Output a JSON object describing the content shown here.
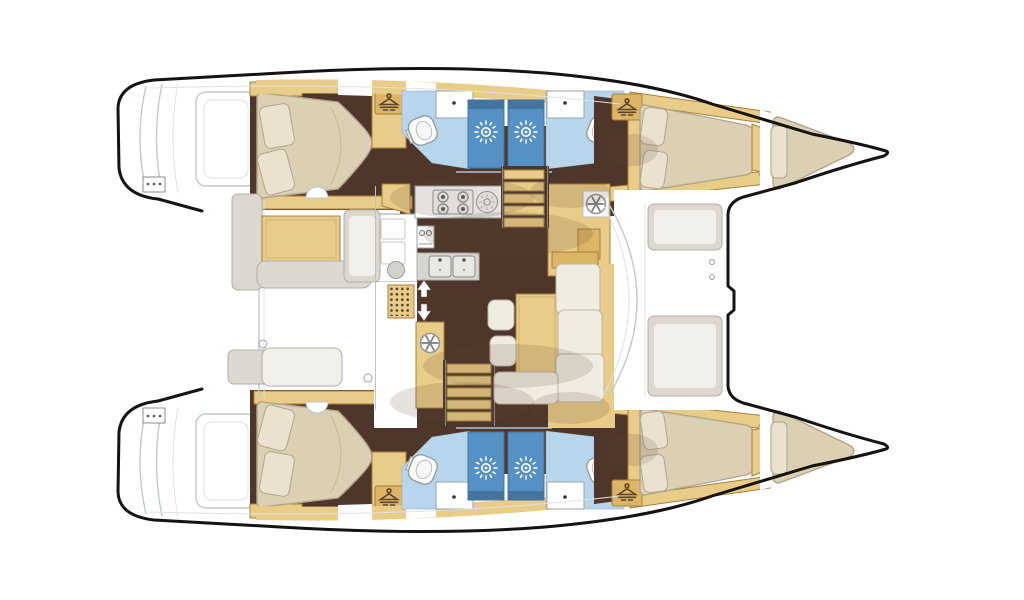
{
  "meta": {
    "kind": "boat floor plan",
    "vessel": "sailing catamaran deck / accommodation plan",
    "view": "top-down",
    "bow_direction": "right",
    "visible_text": "none"
  },
  "palette": {
    "canvas": "#ffffff",
    "hull-outline": "#151210",
    "deck-line": "#c2c9ce",
    "deck-line2": "#dde2e5",
    "wood": "#e9cc87",
    "wood-dark": "#dcb566",
    "wood-edge": "#a5803f",
    "floor": "#4e362a",
    "mattress": "#dcd0b4",
    "mattress-edge": "#b1a68c",
    "pillow": "#eae2cf",
    "cushion": "#f1ece0",
    "cushion-edge": "#bcb6a7",
    "bath-floor": "#b7d6ec",
    "shower-blue": "#5591c4",
    "shower-blue-dark": "#44759e",
    "white-fixture": "#ffffff",
    "fixture-edge": "#9aa1a6",
    "grey-panel": "#dcd8cf",
    "grey-inner": "#f1efe9",
    "grey-panel-edge": "#aeaea8",
    "steel": "#d6d6d1",
    "grate-dot": "#53412f",
    "shadow": "#5f4530",
    "glyph": "#5d4526"
  },
  "layout": {
    "port_hull_top": {
      "rooms": [
        "aft double cabin",
        "aft head with shower stall",
        "forward head with shower stall",
        "forward double cabin",
        "forepeak berth"
      ],
      "stern": "transom steps"
    },
    "starboard_hull_bottom": {
      "rooms": [
        "aft double cabin",
        "aft head with shower stall",
        "forward head with shower stall",
        "forward double cabin",
        "forepeak berth"
      ],
      "stern": "transom steps"
    },
    "bridgedeck": [
      "aft cockpit with table and benches",
      "galley with stove, round sink and double sink",
      "two companionway stairs",
      "salon settee with table and stools",
      "forward cockpit benches",
      "open bow / trampoline area"
    ]
  },
  "counts": {
    "double_berths": 4,
    "forepeak_berths": 2,
    "heads": 4,
    "shower_stalls": 4,
    "toilets": 4,
    "stove_burners": 4,
    "galley_sinks": 2,
    "companionway_stairs": 2
  },
  "icons": {
    "hanger-icon": "clothes hanger = hanging locker",
    "shower-rose-icon": "white sunburst on blue = shower",
    "vent-wheel-icon": "spoked wheel = vent / hatch",
    "stairs-arrows-icon": "up and down block arrows = companionway",
    "burner-icon": "double circle = stove burner",
    "faucet-dot-icon": "small dot = tap on basin"
  }
}
